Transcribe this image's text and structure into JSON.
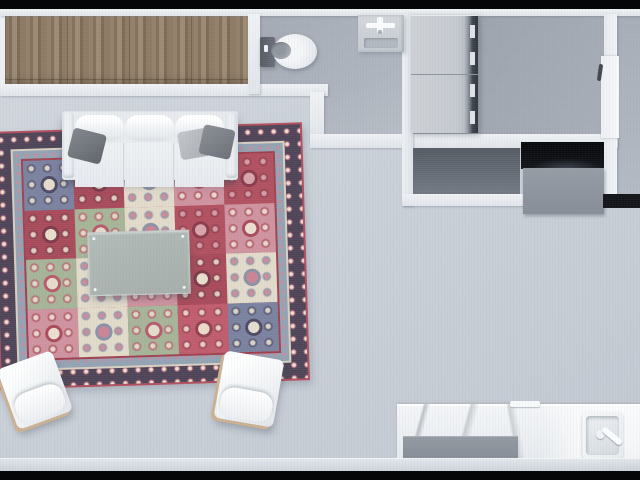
{
  "scene": {
    "title": "Apartment floor plan — top-down 3D render",
    "view": "overhead dollhouse render, no visible text",
    "rooms": {
      "closet": {
        "label": "Built-in closet with wood sliding doors"
      },
      "bathroom": {
        "label": "Bathroom with toilet and pedestal sink"
      },
      "utility": {
        "label": "Utility room with stacked washer and dryer"
      },
      "living": {
        "label": "Living room with sofa, rug, coffee table, two armchairs"
      },
      "media_nook": {
        "label": "Media recess with screen and console"
      },
      "kitchen": {
        "label": "Kitchenette with marble counter and sink"
      }
    },
    "furniture": {
      "sofa": {
        "label": "Three-seat sofa",
        "color": "#eef1f4",
        "pillow_count": 3
      },
      "pillows": {
        "label": "Throw pillows",
        "colors": [
          "#6b7077",
          "#b5b9be",
          "#7d8187"
        ]
      },
      "coffee_table": {
        "label": "Coffee table",
        "color": "#a9b2ae"
      },
      "armchair_left": {
        "label": "White armchair (angled left)",
        "color": "#f2f4f6",
        "trim": "#cbb190"
      },
      "armchair_right": {
        "label": "White armchair (angled right)",
        "color": "#f2f4f6",
        "trim": "#cbb190"
      },
      "rug": {
        "label": "Patchwork oriental rug",
        "border": "#4e4457",
        "edge": "#b14f5e",
        "inner_band": "#93a3b4"
      },
      "toilet": {
        "label": "Toilet",
        "tank": "#60656d",
        "bowl": "#eef0f3"
      },
      "vanity": {
        "label": "Pedestal sink with cross faucet",
        "color": "#ccd1d8"
      },
      "washer": {
        "label": "Washer unit",
        "color": "#c7cbd1"
      },
      "dryer": {
        "label": "Dryer unit",
        "color": "#c7cbd1"
      },
      "screen": {
        "label": "Black screen recess",
        "color": "#0b0d11"
      },
      "console": {
        "label": "Gray media console",
        "color": "#8b929b"
      },
      "counter": {
        "label": "Marble kitchen counter",
        "color": "#eef1f4"
      },
      "cabinet": {
        "label": "Gray base cabinet",
        "color": "#899098"
      },
      "kitchen_sink": {
        "label": "Kitchen sink with faucet",
        "color": "#f4f6f8"
      }
    },
    "palette": {
      "floor_living": "#ccd2d9",
      "floor_bathroom": "#aab0ba",
      "floor_utility": "#a0a7b1",
      "floor_dark_room": "#5c626b",
      "wall": "#e9edf0",
      "wood_floor": "#8a7660",
      "letterbox": "#050607"
    }
  },
  "rug": {
    "tiles": [
      {
        "bg": "#7b82a0",
        "m1": "#e4dccb",
        "m2": "#4e4a66"
      },
      {
        "bg": "#a84a5a",
        "m1": "#e9ddcb",
        "m2": "#7c3a4a"
      },
      {
        "bg": "#e2dbca",
        "m1": "#cb8394",
        "m2": "#8a92a8"
      },
      {
        "bg": "#cf93a0",
        "m1": "#ecdfd2",
        "m2": "#a84a5a"
      },
      {
        "bg": "#b1505f",
        "m1": "#d9a3ab",
        "m2": "#8a3b4b"
      },
      {
        "bg": "#a84a5a",
        "m1": "#e9ddcb",
        "m2": "#7c3a4a"
      },
      {
        "bg": "#a6b497",
        "m1": "#e4dccb",
        "m2": "#b65a6b"
      },
      {
        "bg": "#e2dbca",
        "m1": "#cb8394",
        "m2": "#8a92a8"
      },
      {
        "bg": "#b1505f",
        "m1": "#d9a3ab",
        "m2": "#8a3b4b"
      },
      {
        "bg": "#cf93a0",
        "m1": "#ecdfd2",
        "m2": "#a84a5a"
      },
      {
        "bg": "#a6b497",
        "m1": "#e4dccb",
        "m2": "#b65a6b"
      },
      {
        "bg": "#e2dbca",
        "m1": "#cb8394",
        "m2": "#8a92a8"
      },
      {
        "bg": "#cf93a0",
        "m1": "#ecdfd2",
        "m2": "#a84a5a"
      },
      {
        "bg": "#a84a5a",
        "m1": "#e9ddcb",
        "m2": "#7c3a4a"
      },
      {
        "bg": "#e2dbca",
        "m1": "#cb8394",
        "m2": "#8a92a8"
      },
      {
        "bg": "#cf93a0",
        "m1": "#ecdfd2",
        "m2": "#a84a5a"
      },
      {
        "bg": "#e2dbca",
        "m1": "#cb8394",
        "m2": "#8a92a8"
      },
      {
        "bg": "#a6b497",
        "m1": "#e4dccb",
        "m2": "#b65a6b"
      },
      {
        "bg": "#c05c6d",
        "m1": "#ecd9c9",
        "m2": "#93404f"
      },
      {
        "bg": "#7b82a0",
        "m1": "#e4dccb",
        "m2": "#4e4a66"
      }
    ]
  }
}
